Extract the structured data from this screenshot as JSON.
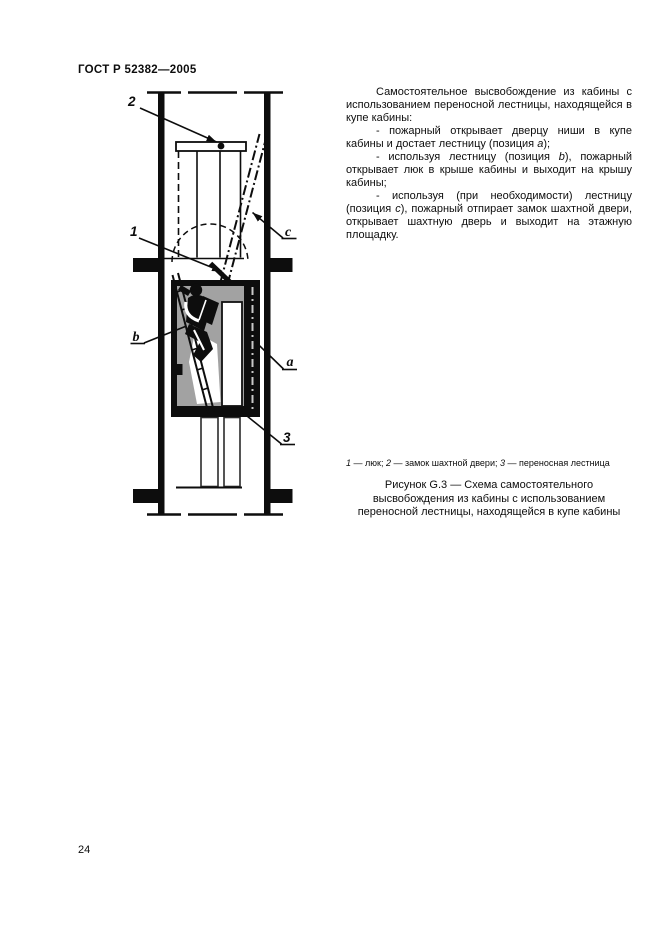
{
  "header": {
    "standard": "ГОСТ Р 52382—2005"
  },
  "footer": {
    "page_number": "24"
  },
  "body_text": {
    "p1": {
      "s0": "Самостоятельное высвобождение из кабины с использованием переносной лестницы, находящейся в купе кабины:"
    },
    "p2": {
      "s0": "- пожарный открывает дверцу ниши в купе кабины и достает лестницу (позиция ",
      "s1": "a",
      "s2": ");"
    },
    "p3": {
      "s0": "- используя лестницу (позиция ",
      "s1": "b",
      "s2": "), пожарный открывает люк в крыше кабины и выходит на крышу кабины;"
    },
    "p4": {
      "s0": "- используя (при необходимости) лестницу (позиция ",
      "s1": "c",
      "s2": "), пожарный отпирает замок шахтной двери, открывает шахтную дверь и выходит на этажную площадку."
    }
  },
  "figure": {
    "legend": {
      "k1": "1",
      "v1": " — люк; ",
      "k2": "2",
      "v2": " — замок шахтной двери; ",
      "k3": "3",
      "v3": " — переносная лестница"
    },
    "caption": "Рисунок G.3 — Схема самостоятельного высвобождения из кабины с использованием переносной лестницы, находящейся в купе кабины",
    "labels": {
      "pos1": "1",
      "pos2": "2",
      "pos3": "3",
      "view_a": "a",
      "view_b": "b",
      "view_c": "c"
    },
    "colors": {
      "ink": "#0d0d0d",
      "cabin_fill": "#a2a2a2"
    }
  }
}
